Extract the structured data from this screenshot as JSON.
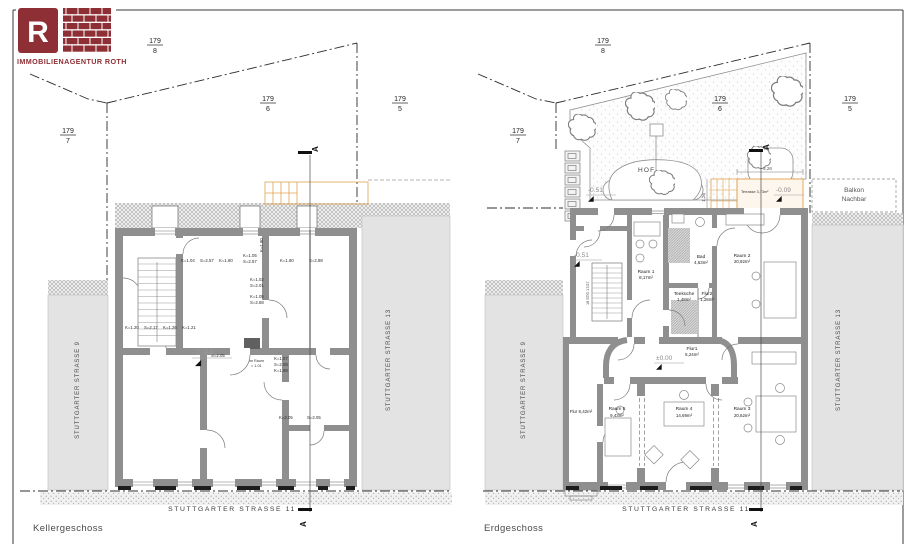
{
  "brand": {
    "letter": "R",
    "name": "IMMOBILIENAGENTUR ROTH",
    "color": "#8e2f36"
  },
  "section_label": "A",
  "streets": {
    "front": "STUTTGARTER STRASSE 11",
    "left_neighbor": "STUTTGARTER STRASSE 9",
    "right_neighbor": "STUTTGARTER STRASSE 13"
  },
  "parcels": {
    "p8": {
      "num": "179",
      "den": "8"
    },
    "p6": {
      "num": "179",
      "den": "6"
    },
    "p5": {
      "num": "179",
      "den": "5"
    },
    "p7": {
      "num": "179",
      "den": "7"
    }
  },
  "kg": {
    "title": "Kellergeschoss",
    "level": "-2.94",
    "room_note_line1": "im Raum",
    "room_note_line2": "= 1.01",
    "annotations": [
      "K=1.04",
      "S=2.57",
      "K=1.80",
      "K=1.05",
      "S=2.57",
      "K=1.80",
      "S=2.88",
      "K=1.02",
      "S=2.01",
      "K=1.05",
      "S=2.88",
      "K=1.20",
      "S=2.17",
      "K=1.26",
      "K=1.21",
      "S=2.05",
      "K=1.07",
      "S=2.08",
      "K=1.88",
      "K=2.05",
      "S=2.05",
      "K=1.80"
    ]
  },
  "eg": {
    "title": "Erdgeschoss",
    "hof": "HOF",
    "terrasse": "Terrasse 3,73m²",
    "balkon_line1": "Balkon",
    "balkon_line2": "Nachbar",
    "levels": {
      "entry": "-0.51",
      "ground": "±0.00",
      "terrace": "-0.09"
    },
    "dims": {
      "terrace_width": "3,26",
      "terrace_depth": "1,26"
    },
    "stair_note": "19 STG 17/27",
    "flur_label": "Flur 8,42m²",
    "rooms": [
      {
        "name": "Raum 1",
        "area": "8,17m²"
      },
      {
        "name": "Bad",
        "area": "4,53m²"
      },
      {
        "name": "Raum 2",
        "area": "20,92m²"
      },
      {
        "name": "Teeküche",
        "area": "1,48m²"
      },
      {
        "name": "Flur2",
        "area": "1,28m²"
      },
      {
        "name": "Flur1",
        "area": "5,24m²"
      },
      {
        "name": "Raum 5",
        "area": "9,43m²"
      },
      {
        "name": "Raum 4",
        "area": "14,69m²"
      },
      {
        "name": "Raum 3",
        "area": "20,62m²"
      }
    ]
  }
}
